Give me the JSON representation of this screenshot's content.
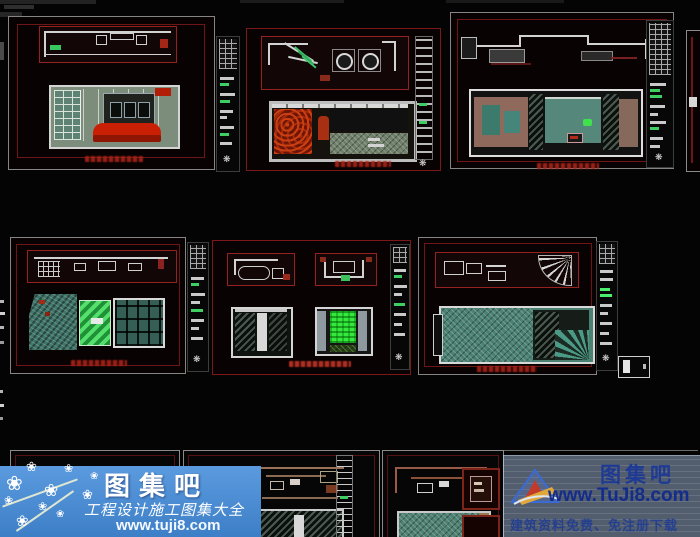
{
  "workspace": {
    "type": "cad-model-space",
    "rows": [
      "top-sheets",
      "middle-sheets",
      "bottom-sheets"
    ]
  },
  "icons": {
    "sheet_marker_glyph": "❋",
    "blossom_glyph": "❀"
  },
  "watermark_left": {
    "brand": "图集吧",
    "tagline": "工程设计施工图集大全",
    "url": "www.tuji8.com",
    "bg_color": "#4a8fd5",
    "text_color": "#ffffff"
  },
  "watermark_right": {
    "brand": "图集吧",
    "url": "www.TuJi8.com",
    "tagline": "建筑资料免费、免注册下载",
    "text_color": "#142c8a"
  },
  "colors": {
    "background": "#040404",
    "sheet_border": "#858585",
    "frame_red": "#6e1515",
    "plan_border": "#952121",
    "caption_red": "#a82318",
    "teal_fill": "#4a8173",
    "sage_fill": "#7d8d7b",
    "sofa_red": "#c92005",
    "bright_green": "#35e83f",
    "stripe_green": "#55e06e",
    "titleblock_green": "#3ecf63"
  }
}
